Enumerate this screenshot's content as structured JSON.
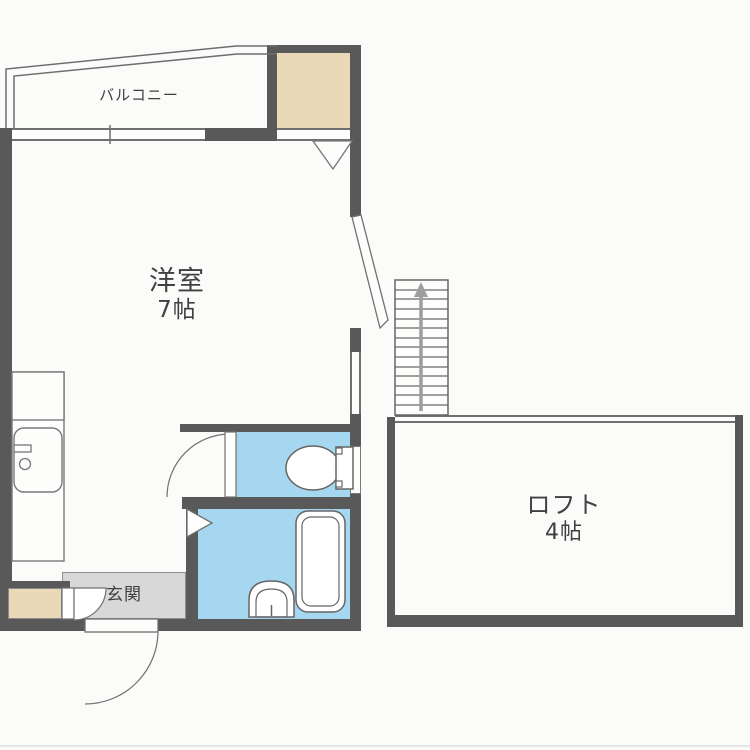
{
  "plan": {
    "type": "apartment-floorplan",
    "rooms": {
      "balcony": {
        "label": "バルコニー"
      },
      "main_room": {
        "label": "洋室",
        "size": "7帖"
      },
      "loft": {
        "label": "ロフト",
        "size": "4帖"
      },
      "entrance": {
        "label": "玄関"
      }
    },
    "stairs": {
      "direction": "up",
      "treads": 13
    },
    "fixtures": [
      "closet",
      "closet-folding-door",
      "kitchen-counter",
      "kitchen-stove-top",
      "kitchen-sink",
      "shoe-cabinet",
      "entrance-door",
      "entrance-inner-door",
      "toilet",
      "toilet-door",
      "toilet-window",
      "bathtub",
      "washbasin",
      "bathroom-door",
      "balcony-window",
      "side-window",
      "open-door-leaf",
      "staircase",
      "loft-rail"
    ]
  },
  "colors": {
    "wall": "#595959",
    "outline": "#707070",
    "wet_area_fill": "#a6d7f0",
    "storage_fill": "#ead9b8",
    "entrance_floor": "#d8d8d8",
    "background": "#fbfbfa",
    "text": "#404040",
    "stairs_arrow": "#9e9e9e"
  }
}
